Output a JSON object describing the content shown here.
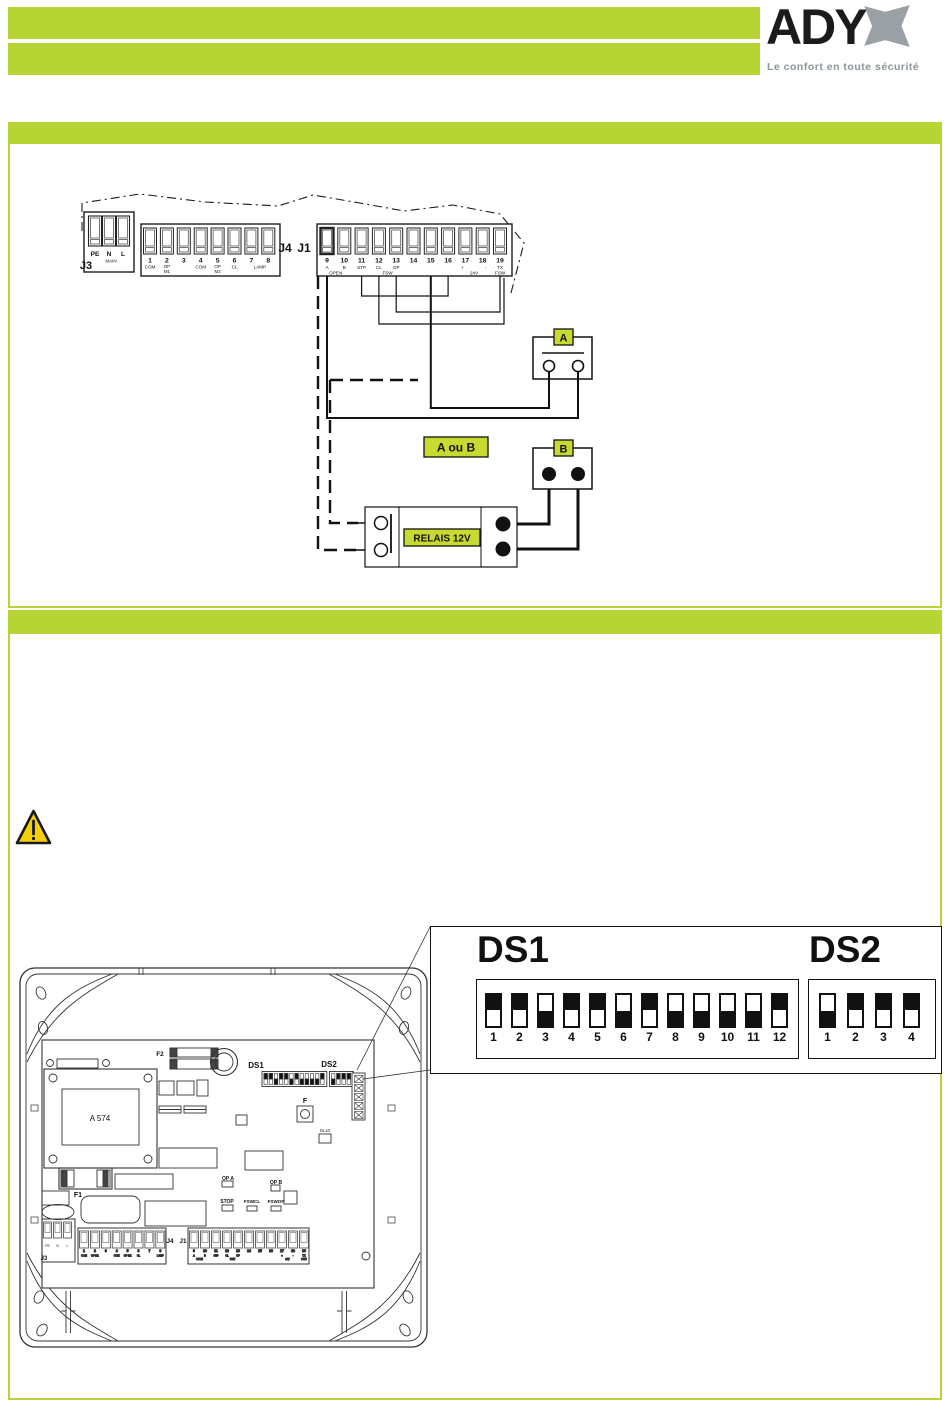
{
  "colors": {
    "bar_green": "#b6d433",
    "label_green": "#c8da2f",
    "logo_gray": "#99a1a5"
  },
  "header": {
    "brand": "ADY",
    "brand_x_icon": "double-arrow-x",
    "tagline": "Le confort en toute sécurité"
  },
  "wiring": {
    "board": {
      "j3_name": "J3",
      "j3_terminals": [
        "PE",
        "N",
        "L"
      ],
      "j3_sub": "MAIN",
      "j4_name": "J4",
      "j1_name": "J1",
      "j4_numbers": [
        "1",
        "2",
        "3",
        "4",
        "5",
        "6",
        "7",
        "8"
      ],
      "j4_labels": [
        "COM",
        "OP|M1",
        "",
        "COM",
        "OP|M2",
        "CL",
        "",
        "LAMP"
      ],
      "j1_numbers": [
        "9",
        "10",
        "11",
        "12",
        "13",
        "14",
        "15",
        "16",
        "17",
        "18",
        "19"
      ],
      "j1_labels": [
        "A",
        "B",
        "STP",
        "CL",
        "OP",
        "",
        "",
        "",
        "+",
        "-",
        "TX"
      ],
      "j1_spans": [
        {
          "text": "OPEN",
          "i": 0.5
        },
        {
          "text": "FSW",
          "i": 3.5
        },
        {
          "text": "24V",
          "i": 8.5
        },
        {
          "text": "FSW",
          "i": 10
        }
      ]
    },
    "device_a_label": "A",
    "device_b_label": "B",
    "choice_label": "A ou B",
    "relay_label": "RELAIS 12V"
  },
  "pcb": {
    "labels": {
      "f2": "F2",
      "ds1": "DS1",
      "ds2": "DS2",
      "f": "F",
      "dl10": "DL10",
      "op_a": "OP A",
      "op_b": "OP B",
      "stop": "STOP",
      "fswcl": "FSWCL",
      "fswop": "FSWOP",
      "f1": "F1",
      "transformer": "A 574",
      "j3": "J3",
      "j4": "J4",
      "j1": "J1"
    }
  },
  "dip_detail": {
    "ds1": {
      "label": "DS1",
      "numbers": [
        "1",
        "2",
        "3",
        "4",
        "5",
        "6",
        "7",
        "8",
        "9",
        "10",
        "11",
        "12"
      ],
      "states": [
        "up",
        "up",
        "down",
        "up",
        "up",
        "down",
        "up",
        "down",
        "down",
        "down",
        "down",
        "up"
      ]
    },
    "ds2": {
      "label": "DS2",
      "numbers": [
        "1",
        "2",
        "3",
        "4"
      ],
      "states": [
        "down",
        "up",
        "up",
        "up"
      ]
    }
  }
}
